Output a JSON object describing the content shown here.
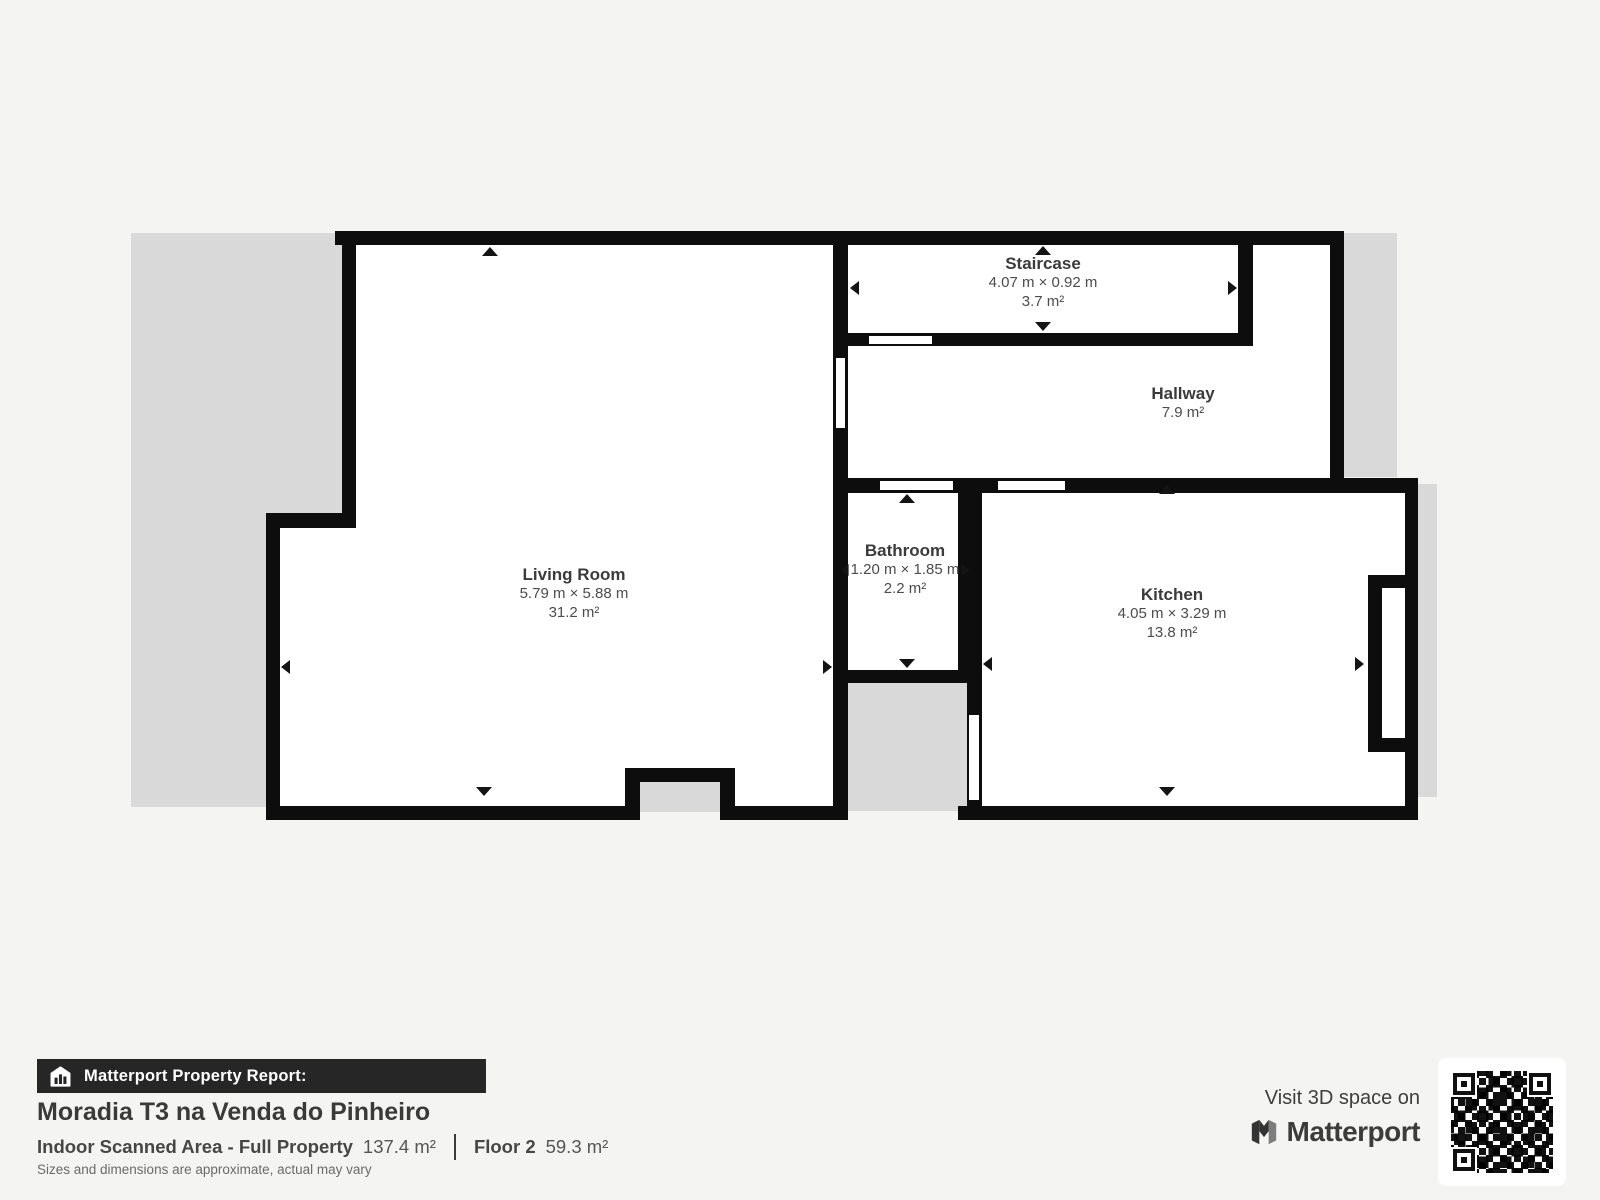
{
  "plan": {
    "rooms": {
      "staircase": {
        "name": "Staircase",
        "dims": "4.07 m × 0.92 m",
        "area": "3.7 m²"
      },
      "hallway": {
        "name": "Hallway",
        "area": "7.9 m²"
      },
      "living_room": {
        "name": "Living Room",
        "dims": "5.79 m × 5.88 m",
        "area": "31.2 m²"
      },
      "bathroom": {
        "name": "Bathroom",
        "dims": "1.20 m × 1.85 m",
        "area": "2.2 m²"
      },
      "kitchen": {
        "name": "Kitchen",
        "dims": "4.05 m × 3.29 m",
        "area": "13.8 m²"
      }
    },
    "colors": {
      "wall": "#0d0d0d",
      "outdoor_area": "#d9d9d9",
      "room_fill": "#ffffff",
      "page_background": "#f4f4f2"
    }
  },
  "footer": {
    "report_label": "Matterport Property Report:",
    "property_title": "Moradia T3 na Venda do Pinheiro",
    "scanned_area_label": "Indoor Scanned Area - Full Property",
    "scanned_area_value": "137.4 m²",
    "floor_label": "Floor 2",
    "floor_value": "59.3 m²",
    "disclaimer": "Sizes and dimensions are approximate, actual may vary"
  },
  "promo": {
    "visit_text": "Visit 3D space on",
    "brand_name": "Matterport"
  }
}
